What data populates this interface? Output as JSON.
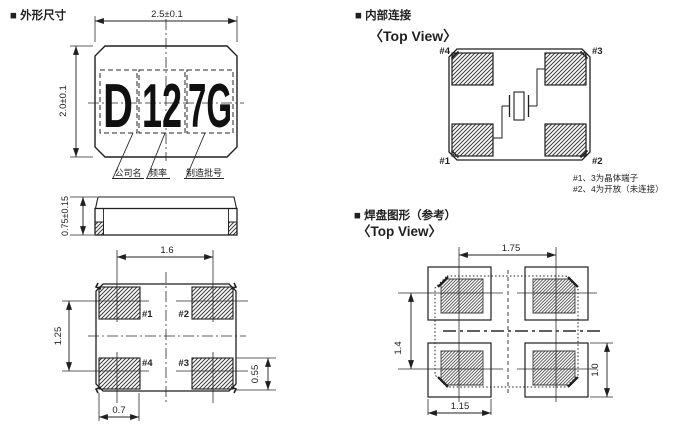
{
  "outline": {
    "title": "■ 外形尺寸",
    "dim_width": "2.5±0.1",
    "dim_height": "2.0±0.1",
    "dim_thickness": "0.75±0.15",
    "marking": [
      "D",
      "12",
      "7G"
    ],
    "marking_labels": [
      "公司名",
      "频率",
      "制造批号"
    ],
    "bottom": {
      "dim_pitch_x": "1.6",
      "dim_pitch_y": "1.25",
      "dim_pad_w": "0.7",
      "dim_pad_h": "0.55",
      "pad1": "#1",
      "pad2": "#2",
      "pad3": "#3",
      "pad4": "#4"
    }
  },
  "internal": {
    "title": "■ 内部连接",
    "subtitle": "〈Top View〉",
    "pad1": "#1",
    "pad2": "#2",
    "pad3": "#3",
    "pad4": "#4",
    "note1": "#1、3为晶体端子",
    "note2": "#2、4为开放（未连接）"
  },
  "land": {
    "title": "■ 焊盘图形（参考）",
    "subtitle": "〈Top View〉",
    "dim_pitch_x": "1.75",
    "dim_pitch_y": "1.4",
    "dim_pad_w": "1.15",
    "dim_pad_h": "1.0"
  }
}
